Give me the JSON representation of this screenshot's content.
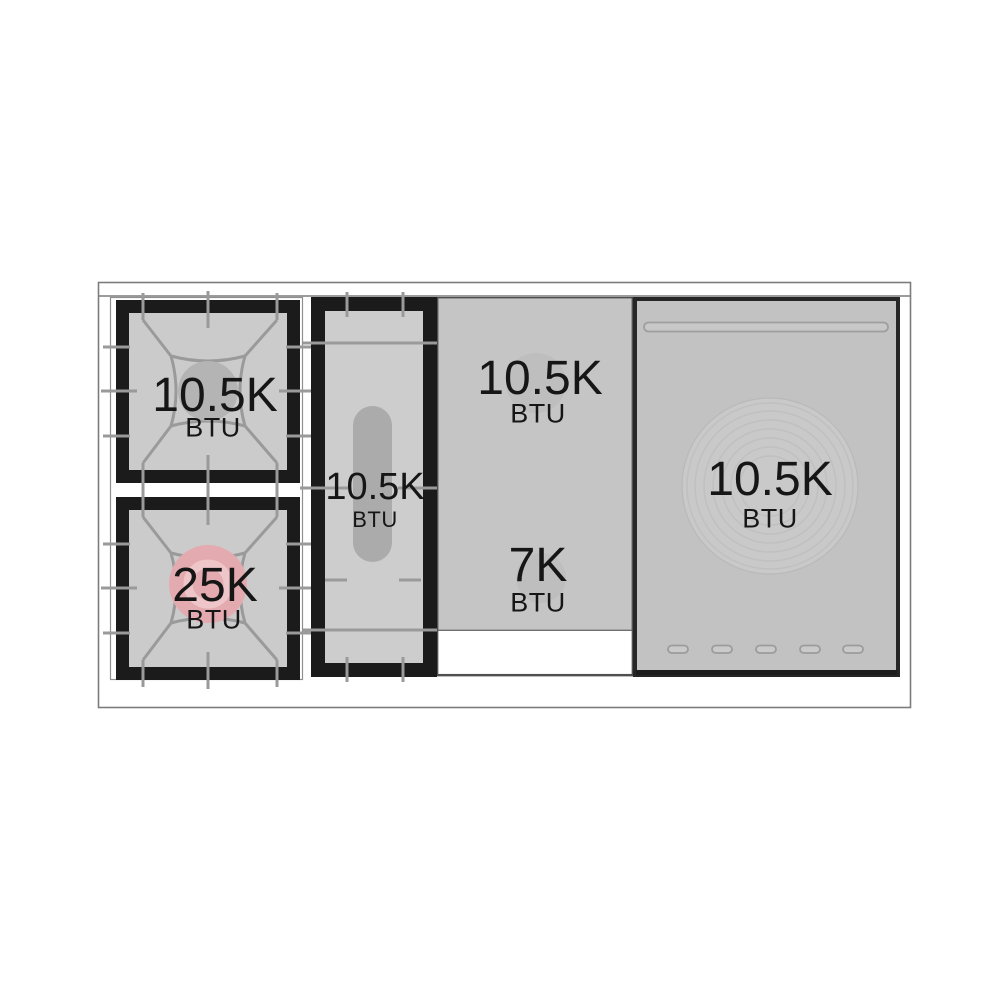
{
  "diagram": {
    "kind": "range-cooktop-burner-spec",
    "sections": [
      {
        "name": "left-dual-burner-section",
        "burners": [
          {
            "value": "10.5K",
            "unit": "BTU",
            "cap_color": "#b4b4b4"
          },
          {
            "value": "25K",
            "unit": "BTU",
            "cap_color": "#e3abaf"
          }
        ]
      },
      {
        "name": "griddle-burner-section",
        "burners": [
          {
            "value": "10.5K",
            "unit": "BTU",
            "cap_color": "#ababab"
          }
        ]
      },
      {
        "name": "center-panel-section",
        "burners": [
          {
            "value": "10.5K",
            "unit": "BTU",
            "cap_color": "#b9b9b9"
          },
          {
            "value": "7K",
            "unit": "BTU",
            "cap_color": "#b9b9b9"
          }
        ]
      },
      {
        "name": "right-panel-section",
        "burners": [
          {
            "value": "10.5K",
            "unit": "BTU",
            "cap_color": "#c9c9c9"
          }
        ]
      }
    ],
    "colors": {
      "grate_frame_black": "#1b1b1b",
      "grate_interior_gray": "#cbcbcb",
      "grate_line_gray": "#9a9a9a",
      "panel_gray": "#c5c5c5",
      "right_panel_gray": "#c2c2c2",
      "highlight_pink": "#e3abaf",
      "outline_gray": "#7c7c7c",
      "text_black": "#161616"
    }
  }
}
